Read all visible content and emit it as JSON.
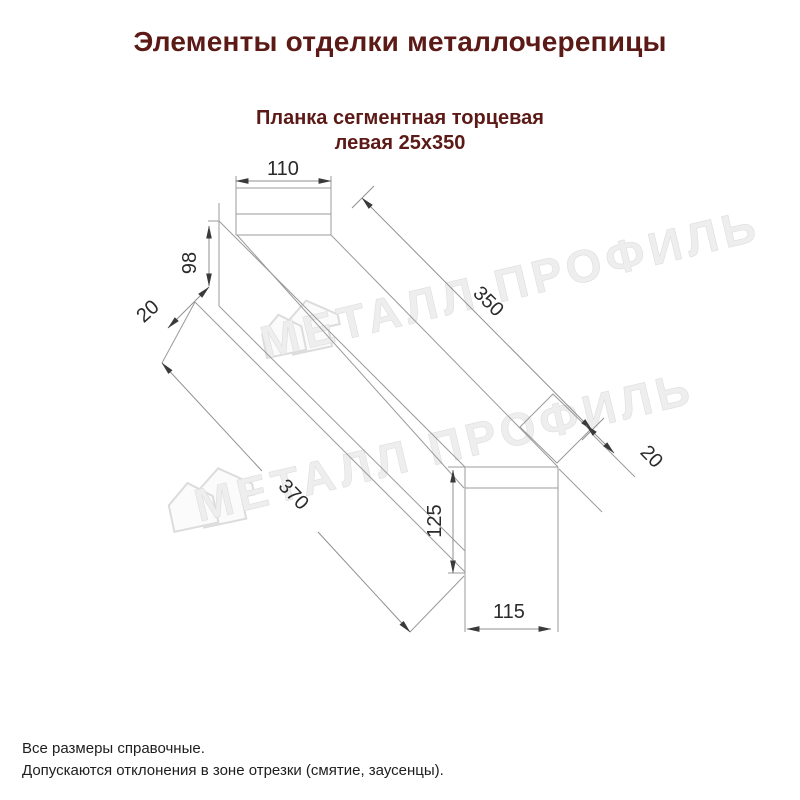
{
  "page": {
    "title": "Элементы отделки металлочерепицы",
    "subtitle_line1": "Планка сегментная торцевая",
    "subtitle_line2": "левая 25х350"
  },
  "drawing": {
    "dims": {
      "top_width": "110",
      "left_height": "98",
      "left_hem": "20",
      "top_edge_length": "350",
      "bottom_edge_length": "370",
      "right_hem": "20",
      "end_height": "125",
      "end_width": "115"
    }
  },
  "watermark": {
    "text": "МЕТАЛЛ ПРОФИЛЬ"
  },
  "notes": {
    "line1": "Все размеры справочные.",
    "line2": "Допускаются отклонения в зоне отрезки (смятие, заусенцы)."
  }
}
